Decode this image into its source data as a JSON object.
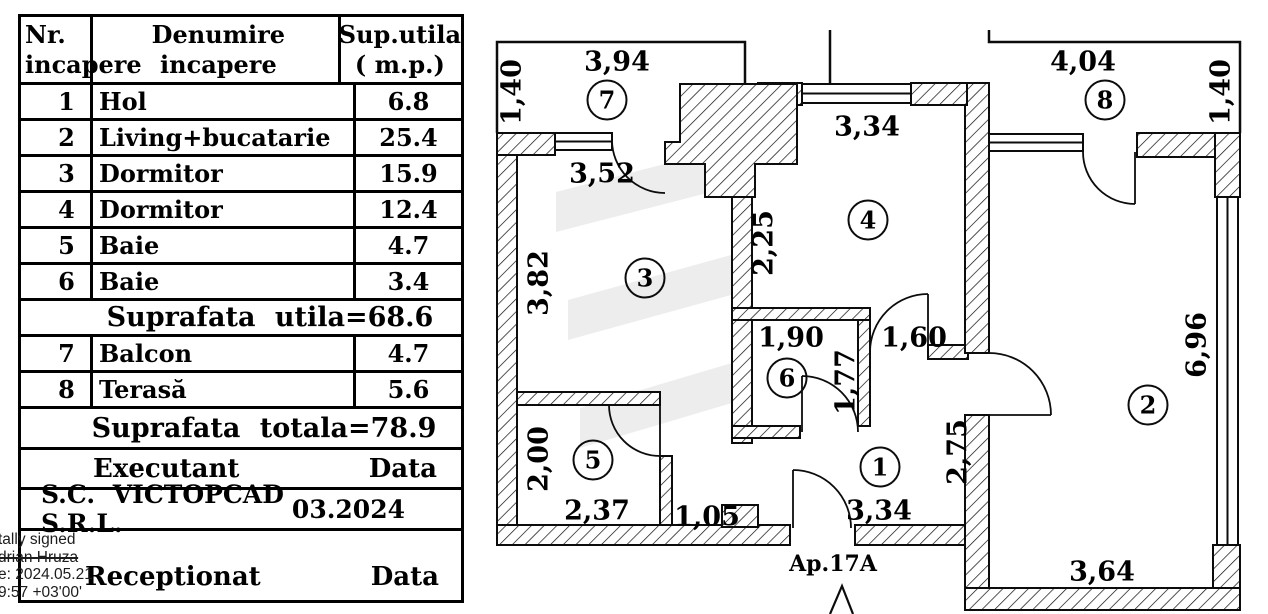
{
  "table": {
    "header": {
      "col1_l1": "Nr.",
      "col1_l2": "incapere",
      "col2_l1": "Denumire",
      "col2_l2": "incapere",
      "col3_l1": "Sup.utila",
      "col3_l2": "( m.p.)"
    },
    "rows": [
      {
        "num": "1",
        "name": "Hol",
        "area": "6.8"
      },
      {
        "num": "2",
        "name": "Living+bucatarie",
        "area": "25.4"
      },
      {
        "num": "3",
        "name": "Dormitor",
        "area": "15.9"
      },
      {
        "num": "4",
        "name": "Dormitor",
        "area": "12.4"
      },
      {
        "num": "5",
        "name": "Baie",
        "area": "4.7"
      },
      {
        "num": "6",
        "name": "Baie",
        "area": "3.4"
      }
    ],
    "subtotal": "Suprafata utila=68.6",
    "rows_extra": [
      {
        "num": "7",
        "name": "Balcon",
        "area": "4.7"
      },
      {
        "num": "8",
        "name": "Terasă",
        "area": "5.6"
      }
    ],
    "total": "Suprafata totala=78.9",
    "executant": {
      "label": "Executant",
      "data": "Data"
    },
    "company": {
      "name": "S.C. VICTOPCAD S.R.L.",
      "date": "03.2024"
    },
    "receptionat": {
      "label": "Receptionat",
      "data": "Data"
    }
  },
  "signature": {
    "line1": "tally signed",
    "line2": "drian Hruza",
    "line3": "e: 2024.05.21",
    "line4": "9:57 +03'00'"
  },
  "plan": {
    "apartment_label": "Ap.17A",
    "rooms": [
      {
        "n": "1",
        "x": 880,
        "y": 467
      },
      {
        "n": "2",
        "x": 1148,
        "y": 405
      },
      {
        "n": "3",
        "x": 645,
        "y": 278
      },
      {
        "n": "4",
        "x": 868,
        "y": 220
      },
      {
        "n": "5",
        "x": 593,
        "y": 460
      },
      {
        "n": "6",
        "x": 787,
        "y": 378
      },
      {
        "n": "7",
        "x": 607,
        "y": 100
      },
      {
        "n": "8",
        "x": 1105,
        "y": 100
      }
    ],
    "dimensions": [
      {
        "t": "3,94",
        "x": 617,
        "y": 62
      },
      {
        "t": "1,40",
        "x": 512,
        "y": 92,
        "r": 1
      },
      {
        "t": "4,04",
        "x": 1083,
        "y": 62
      },
      {
        "t": "1,40",
        "x": 1221,
        "y": 92,
        "r": 1
      },
      {
        "t": "3,34",
        "x": 867,
        "y": 127
      },
      {
        "t": "3,52",
        "x": 602,
        "y": 174
      },
      {
        "t": "2,25",
        "x": 764,
        "y": 243,
        "r": 1
      },
      {
        "t": "3,82",
        "x": 539,
        "y": 283,
        "r": 1
      },
      {
        "t": "1,90",
        "x": 791,
        "y": 338
      },
      {
        "t": "1,60",
        "x": 914,
        "y": 338
      },
      {
        "t": "1,77",
        "x": 846,
        "y": 382,
        "r": 1
      },
      {
        "t": "6,96",
        "x": 1197,
        "y": 345,
        "r": 1
      },
      {
        "t": "2,00",
        "x": 539,
        "y": 459,
        "r": 1
      },
      {
        "t": "2,75",
        "x": 958,
        "y": 452,
        "r": 1
      },
      {
        "t": "2,37",
        "x": 597,
        "y": 511
      },
      {
        "t": "1,05",
        "x": 707,
        "y": 517
      },
      {
        "t": "3,34",
        "x": 879,
        "y": 511
      },
      {
        "t": "3,64",
        "x": 1102,
        "y": 572
      }
    ]
  }
}
